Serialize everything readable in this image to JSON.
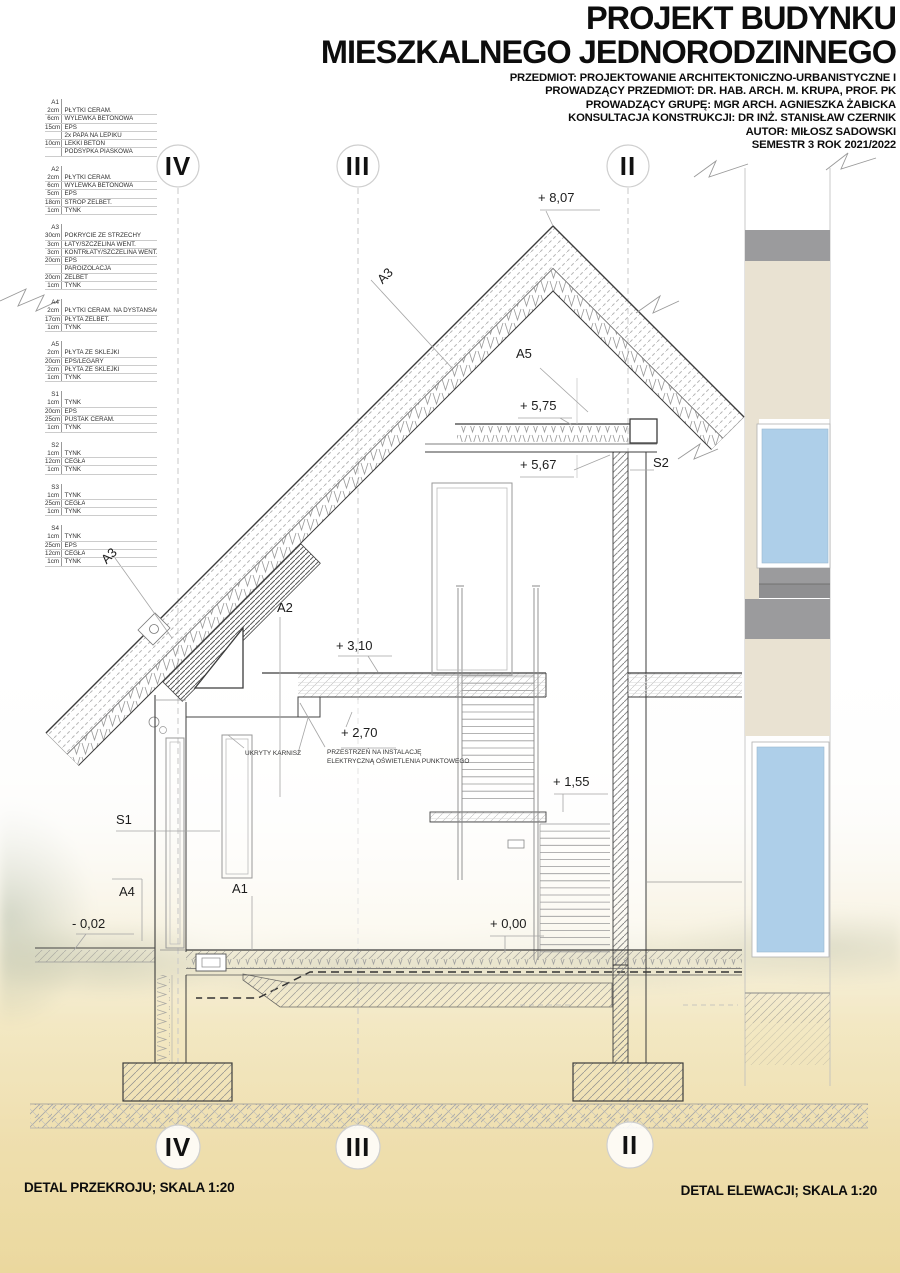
{
  "title": {
    "line1": "PROJEKT BUDYNKU",
    "line2": "MIESZKALNEGO JEDNORODZINNEGO"
  },
  "subtitles": [
    "PRZEDMIOT: PROJEKTOWANIE ARCHITEKTONICZNO-URBANISTYCZNE I",
    "PROWADZĄCY PRZEDMIOT: DR. HAB. ARCH. M. KRUPA, PROF. PK",
    "PROWADZĄCY GRUPĘ: MGR ARCH. AGNIESZKA ŻABICKA",
    "KONSULTACJA KONSTRUKCJI: DR INŻ. STANISŁAW CZERNIK",
    "AUTOR: MIŁOSZ SADOWSKI",
    "SEMESTR 3 ROK 2021/2022"
  ],
  "legend": {
    "tables": [
      {
        "id": "A1",
        "rows": [
          [
            "2cm",
            "PŁYTKI CERAM."
          ],
          [
            "6cm",
            "WYLEWKA BETONOWA"
          ],
          [
            "15cm",
            "EPS"
          ],
          [
            "",
            "2x PAPA NA LEPIKU"
          ],
          [
            "10cm",
            "LEKKI BETON"
          ],
          [
            "",
            "PODSYPKA PIASKOWA"
          ]
        ]
      },
      {
        "id": "A2",
        "rows": [
          [
            "2cm",
            "PŁYTKI CERAM."
          ],
          [
            "6cm",
            "WYLEWKA BETONOWA"
          ],
          [
            "5cm",
            "EPS"
          ],
          [
            "18cm",
            "STROP ŻELBET."
          ],
          [
            "1cm",
            "TYNK"
          ]
        ]
      },
      {
        "id": "A3",
        "rows": [
          [
            "30cm",
            "POKRYCIE ZE STRZECHY"
          ],
          [
            "3cm",
            "ŁATY/SZCZELINA WENT."
          ],
          [
            "3cm",
            "KONTRŁATY/SZCZELINA WENT."
          ],
          [
            "20cm",
            "EPS"
          ],
          [
            "",
            "PAROIZOLACJA"
          ],
          [
            "20cm",
            "ŻELBET"
          ],
          [
            "1cm",
            "TYNK"
          ]
        ]
      },
      {
        "id": "A4",
        "rows": [
          [
            "2cm",
            "PŁYTKI CERAM. NA DYSTANSACH"
          ],
          [
            "17cm",
            "PŁYTA ŻELBET."
          ],
          [
            "1cm",
            "TYNK"
          ]
        ]
      },
      {
        "id": "A5",
        "rows": [
          [
            "2cm",
            "PŁYTA ZE SKLEJKI"
          ],
          [
            "20cm",
            "EPS/LEGARY"
          ],
          [
            "2cm",
            "PŁYTA ZE SKLEJKI"
          ],
          [
            "1cm",
            "TYNK"
          ]
        ]
      },
      {
        "id": "S1",
        "rows": [
          [
            "1cm",
            "TYNK"
          ],
          [
            "20cm",
            "EPS"
          ],
          [
            "25cm",
            "PUSTAK CERAM."
          ],
          [
            "1cm",
            "TYNK"
          ]
        ]
      },
      {
        "id": "S2",
        "rows": [
          [
            "1cm",
            "TYNK"
          ],
          [
            "12cm",
            "CEGŁA"
          ],
          [
            "1cm",
            "TYNK"
          ]
        ]
      },
      {
        "id": "S3",
        "rows": [
          [
            "1cm",
            "TYNK"
          ],
          [
            "25cm",
            "CEGŁA"
          ],
          [
            "1cm",
            "TYNK"
          ]
        ]
      },
      {
        "id": "S4",
        "rows": [
          [
            "1cm",
            "TYNK"
          ],
          [
            "25cm",
            "EPS"
          ],
          [
            "12cm",
            "CEGŁA"
          ],
          [
            "1cm",
            "TYNK"
          ]
        ]
      }
    ]
  },
  "markers": {
    "top": [
      "IV",
      "III",
      "II"
    ],
    "bottom": [
      "IV",
      "III",
      "II"
    ]
  },
  "labels": {
    "lvl_807": "+ 8,07",
    "lvl_575": "+ 5,75",
    "lvl_567": "+ 5,67",
    "lvl_310": "+ 3,10",
    "lvl_270": "+ 2,70",
    "lvl_155": "+ 1,55",
    "lvl_000": "+ 0,00",
    "lvl_m002": "- 0,02",
    "a3_upper": "A3",
    "a3_lower": "A3",
    "a5": "A5",
    "a2": "A2",
    "a1": "A1",
    "a4": "A4",
    "s1": "S1",
    "s2": "S2",
    "note_karnisz": "UKRYTY KARNISZ",
    "note_instal_1": "PRZESTRZEŃ NA INSTALACJĘ",
    "note_instal_2": "ELEKTRYCZNĄ OŚWIETLENIA PUNKTOWEGO"
  },
  "footer": {
    "left": "DETAL PRZEKROJU; SKALA 1:20",
    "right": "DETAL ELEWACJI; SKALA 1:20"
  },
  "colors": {
    "facade_beige": "#e9e2d2",
    "facade_gray": "#9b9b9d",
    "facade_gray_dark": "#8f8f91",
    "window_blue": "#aecfe9"
  }
}
